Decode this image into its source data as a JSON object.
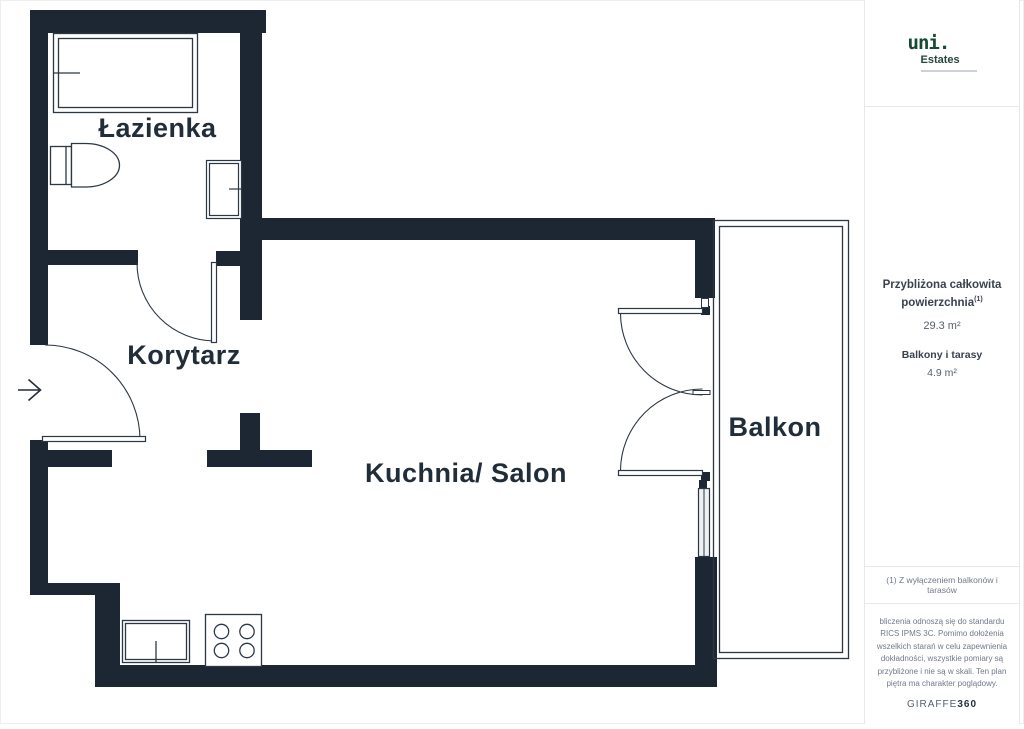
{
  "sidebar": {
    "logo": {
      "brand": "uni.",
      "sub_brand": "Estates"
    },
    "area_summary": {
      "title": "Przybliżona całkowita powierzchnia",
      "title_sup": "(1)",
      "total_value": "29.3 m²",
      "balcony_title": "Balkony i tarasy",
      "balcony_value": "4.9 m²"
    },
    "footnote": "(1) Z wyłączeniem balkonów i tarasów",
    "disclaimer": "bliczenia odnoszą się do standardu RICS IPMS 3C. Pomimo dołożenia wszelkich starań w celu zapewnienia dokładności, wszystkie pomiary są przybliżone i nie są w skali. Ten plan piętra ma charakter poglądowy.",
    "brand_footer": {
      "light": "GIRAFFE",
      "bold": "360"
    }
  },
  "floor_plan": {
    "rooms": {
      "bathroom": "Łazienka",
      "corridor": "Korytarz",
      "kitchen_living": "Kuchnia/ Salon",
      "balcony": "Balkon"
    }
  },
  "colors": {
    "wall": "#1d2734",
    "line": "#2b3744",
    "logo_green": "#174a33",
    "divider": "#e7e8ea",
    "text_dark": "#222d3a",
    "text_gray": "#70798a"
  }
}
